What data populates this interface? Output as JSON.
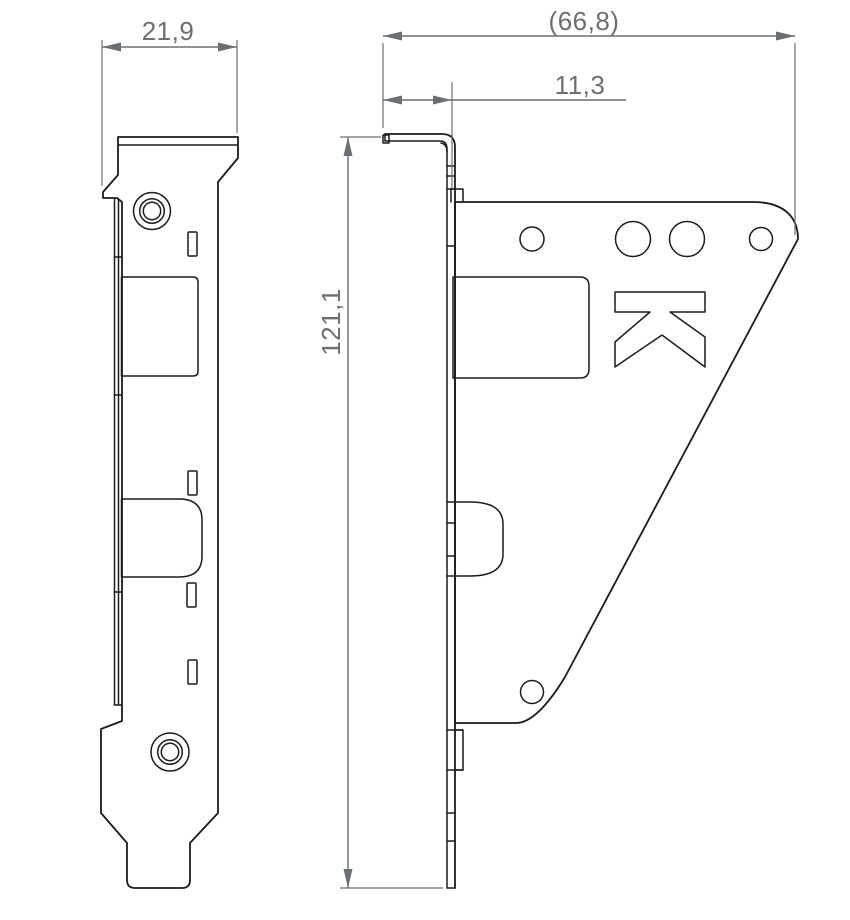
{
  "colors": {
    "outline": "#1c1c1c",
    "dimension": "#6b6f72",
    "background": "#ffffff"
  },
  "dimensions": {
    "tab_width": {
      "label": "21,9"
    },
    "overall_depth": {
      "label": "(66,8)"
    },
    "flange_offset": {
      "label": "11,3"
    },
    "overall_height": {
      "label": "121,1"
    }
  }
}
